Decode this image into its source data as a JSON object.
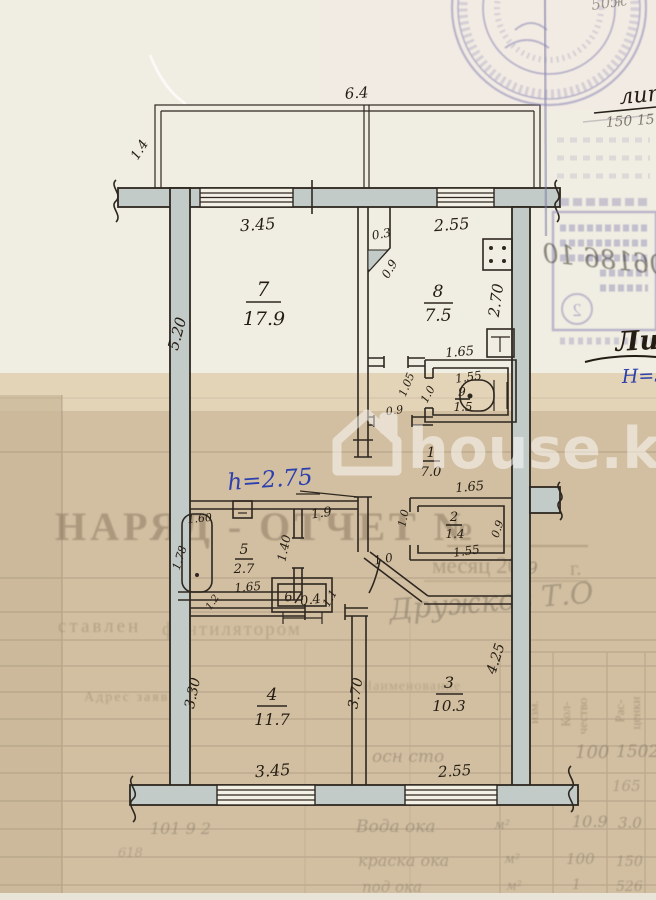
{
  "watermark": {
    "text": "house.kg"
  },
  "notes": {
    "ceiling_height": "h=2.75",
    "lit_small": "лит",
    "red_nums": "150 15",
    "lit_big": "Лит.",
    "building_height": "Н=3.0",
    "mirror_script": "06186 10",
    "top_script": "50ж",
    "stamp_number": "2"
  },
  "rooms": [
    {
      "num": "1",
      "area": "7.0"
    },
    {
      "num": "2",
      "area": "1.4"
    },
    {
      "num": "3",
      "area": "10.3"
    },
    {
      "num": "4",
      "area": "11.7"
    },
    {
      "num": "5",
      "area": "2.7"
    },
    {
      "num": "6",
      "area": "0.4"
    },
    {
      "num": "7",
      "area": "17.9"
    },
    {
      "num": "8",
      "area": "7.5"
    },
    {
      "num": "9",
      "area": "1.5"
    }
  ],
  "dims": {
    "balcony_width": "6.4",
    "balcony_depth": "1.4",
    "r7_width": "3.45",
    "r7_depth": "5.20",
    "r8_width": "2.55",
    "r8_depth": "2.70",
    "niche": "0.3",
    "niche_door": "0.9",
    "wc_top": "1.65",
    "wc_width": "1.55",
    "wc_depth": "1.05",
    "wc_door": "1.0",
    "lobby_door": "0.9",
    "cl_top": "1.65",
    "cl_width": "1.55",
    "cl_side": "0.9",
    "cl_door": "1.0",
    "hall_width": "1.9",
    "hall_depth": "1.40",
    "bath_width": "1.60",
    "bath_side": "1.78",
    "bath_bottom": "1.65",
    "bath_door": "1.2",
    "shaft_side": "1.1",
    "entry_door": "1.0",
    "r4_depth": "3.30",
    "r4_width": "3.45",
    "wall_43": "3.70",
    "r3_depth": "4.25",
    "r3_width": "2.55"
  },
  "form": {
    "title": "НАРЯД - ОТЧЕТ №",
    "month_line": "месяц 200",
    "year_suffix": "г.",
    "year_digit": "9",
    "prepared_frag1": "ставлен",
    "prepared_frag2": "фентилятором",
    "address_frag": "Адрес заявл",
    "name_header": "Наименование",
    "unit_header1": "ед.",
    "unit_header2": "изм.",
    "qty_header1": "Кол-",
    "qty_header2": "чество",
    "price_header1": "Рас-",
    "price_header2": "ценки",
    "signature": "Дружков Т.О",
    "left_nums": "101 9 2",
    "left_num2": "618",
    "rows": [
      {
        "desc": "осн сто",
        "unit": "м²",
        "qty": "100",
        "price": "1502"
      },
      {
        "price": "165"
      },
      {
        "desc": "Вода ока",
        "unit": "м²",
        "qty": "10.9",
        "price": "3.0"
      },
      {
        "desc": "краска ока",
        "unit": "м²",
        "qty": "100",
        "price": "150"
      },
      {
        "desc": "под ока",
        "unit": "м²",
        "qty": "1",
        "price": "526"
      }
    ]
  }
}
